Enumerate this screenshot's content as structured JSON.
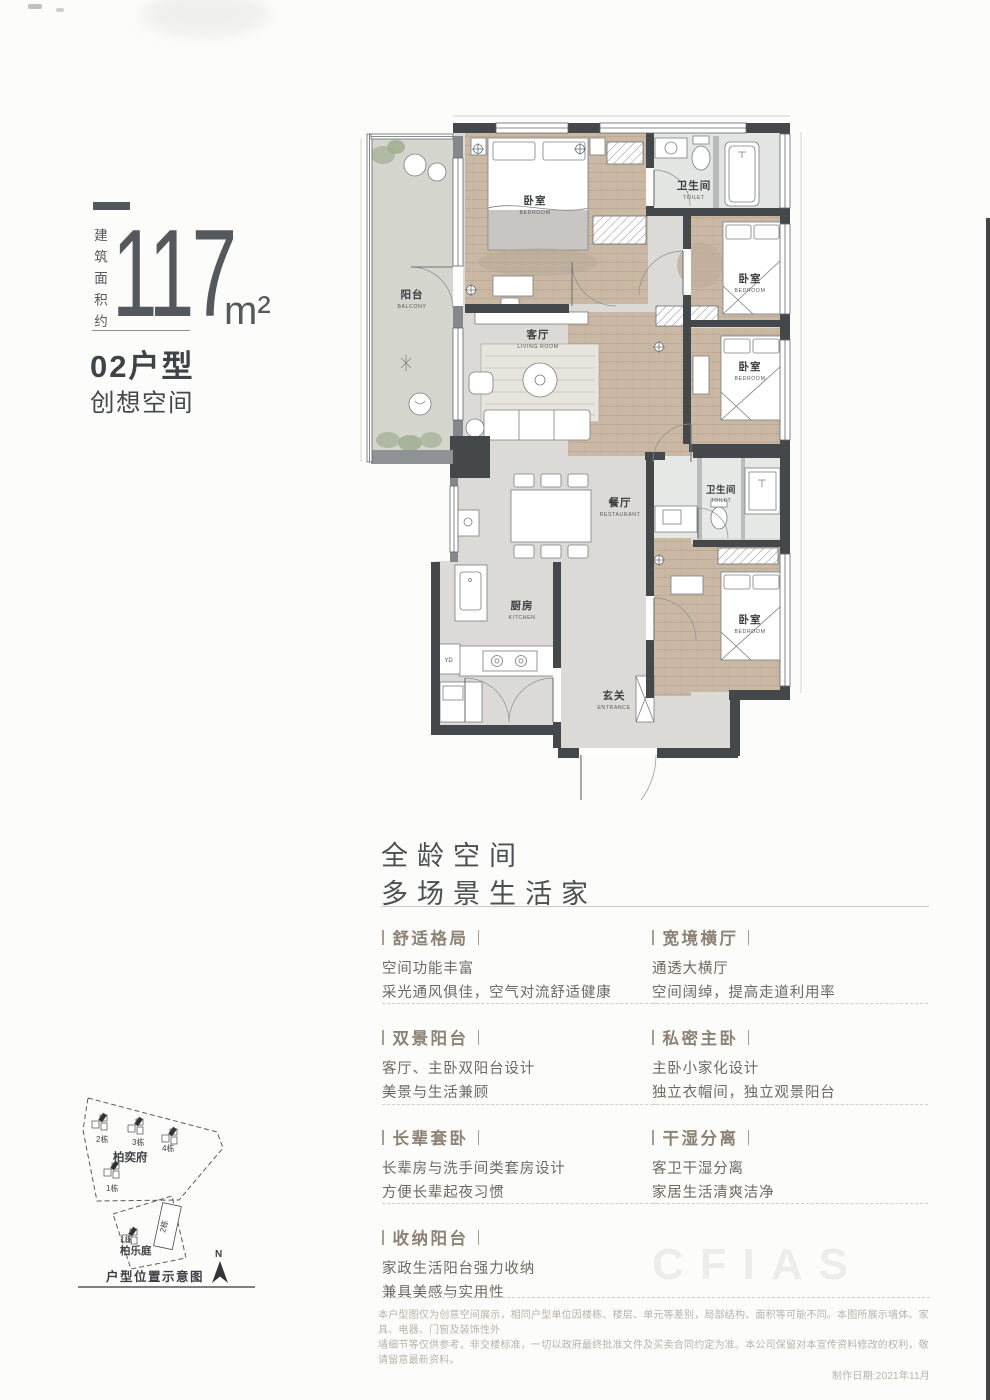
{
  "left_panel": {
    "area_prefix": "建筑面积约",
    "area_number": "117",
    "area_unit": "m²",
    "unit_code": "02户型",
    "unit_name": "创想空间"
  },
  "floorplan": {
    "rooms": {
      "balcony": {
        "cn": "阳台",
        "en": "BALCONY"
      },
      "master_bedroom": {
        "cn": "卧室",
        "en": "BEDROOM"
      },
      "bath_top": {
        "cn": "卫生间",
        "en": "TOILET"
      },
      "bedroom_upper": {
        "cn": "卧室",
        "en": "BEDROOM"
      },
      "living": {
        "cn": "客厅",
        "en": "LIVING ROOM"
      },
      "bedroom_middle": {
        "cn": "卧室",
        "en": "BEDROOM"
      },
      "dining": {
        "cn": "餐厅",
        "en": "RESTAURANT"
      },
      "bath_mid": {
        "cn": "卫生间",
        "en": "TOILET"
      },
      "kitchen": {
        "cn": "厨房",
        "en": "KITCHEN"
      },
      "bedroom_lower": {
        "cn": "卧室",
        "en": "BEDROOM"
      },
      "entrance": {
        "cn": "玄关",
        "en": "ENTRANCE"
      }
    },
    "appliance": "YD"
  },
  "features": {
    "heading1": "全龄空间",
    "heading2": "多场景生活家",
    "left": [
      {
        "title": "舒适格局",
        "line1": "空间功能丰富",
        "line2": "采光通风俱佳，空气对流舒适健康"
      },
      {
        "title": "双景阳台",
        "line1": "客厅、主卧双阳台设计",
        "line2": "美景与生活兼顾"
      },
      {
        "title": "长辈套卧",
        "line1": "长辈房与洗手间类套房设计",
        "line2": "方便长辈起夜习惯"
      },
      {
        "title": "收纳阳台",
        "line1": "家政生活阳台强力收纳",
        "line2": "兼具美感与实用性"
      }
    ],
    "right": [
      {
        "title": "宽境横厅",
        "line1": "通透大横厅",
        "line2": "空间阔绰，提高走道利用率"
      },
      {
        "title": "私密主卧",
        "line1": "主卧小家化设计",
        "line2": "独立衣帽间，独立观景阳台"
      },
      {
        "title": "干湿分离",
        "line1": "客卫干湿分离",
        "line2": "家居生活清爽洁净"
      }
    ]
  },
  "sitemap": {
    "phase1_name": "柏奕府",
    "phase1_buildings": [
      "2栋",
      "3栋",
      "4栋",
      "1栋"
    ],
    "phase2_name": "柏乐庭",
    "phase2_buildings": [
      "1栋",
      "2栋"
    ],
    "north": "N",
    "caption": "户型位置示意图"
  },
  "watermark": "CFIAS",
  "disclaimer": {
    "line1": "本户型图仅为创意空间展示，相同户型单位因楼栋、楼层、单元等差别，局部结构、面积等可能不同。本图所展示墙体、家具、电器、门窗及装饰性外",
    "line2": "墙细节等仅供参考，非交楼标准，一切以政府最终批准文件及买卖合同约定为准。本公司保留对本宣传资料修改的权利，敬请留意最新资料。",
    "date": "制作日期:2021年11月"
  },
  "colors": {
    "wall": "#45484b",
    "wood_floor": "#c9b8a4",
    "tile_floor": "#dcdad6",
    "balcony_floor": "#d4d6ce",
    "feature_title": "#8d8276",
    "body_text": "#6e6963",
    "accent": "#4c5053"
  }
}
